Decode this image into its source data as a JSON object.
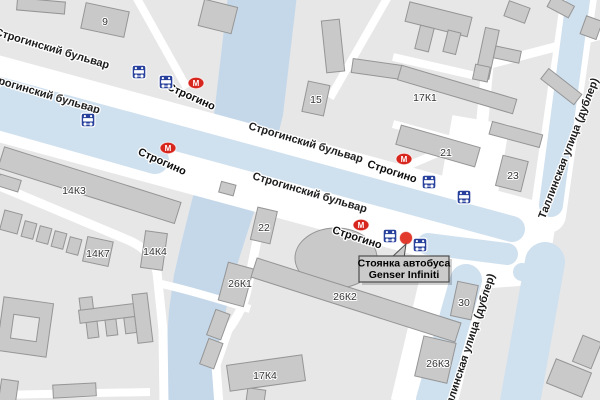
{
  "map": {
    "type": "city-street-map",
    "streets": {
      "boulevard": "Строгинский бульвар",
      "tallinskaya": "Таллинская улица (дублер)"
    },
    "metro": {
      "symbol": "М",
      "station": "Строгино",
      "station_count": 4
    },
    "buildings": {
      "b9": "9",
      "b15": "15",
      "b17k1": "17К1",
      "b21": "21",
      "b23": "23",
      "b14k3": "14К3",
      "b14k7": "14К7",
      "b14k4": "14К4",
      "b22": "22",
      "b26k1": "26К1",
      "b26k2": "26К2",
      "b17k4": "17К4",
      "b30": "30",
      "b26k3": "26К3"
    },
    "callout": {
      "line1": "Стоянка автобуса",
      "line2": "Genser Infiniti"
    },
    "icons": {
      "bus_stop_count": 7,
      "marker": "red-dot"
    },
    "colors": {
      "block": "#e7e7e7",
      "road": "#ffffff",
      "road_blue": "#cfe0ef",
      "water": "#c5d8ea",
      "building": "#c9c9c9",
      "building_stroke": "#959595",
      "metro_red": "#d7261d",
      "bus_blue": "#27409b",
      "marker_red": "#e23b2e",
      "callout_bg": "#cbcbcb",
      "callout_border": "#4d4d4d"
    }
  }
}
